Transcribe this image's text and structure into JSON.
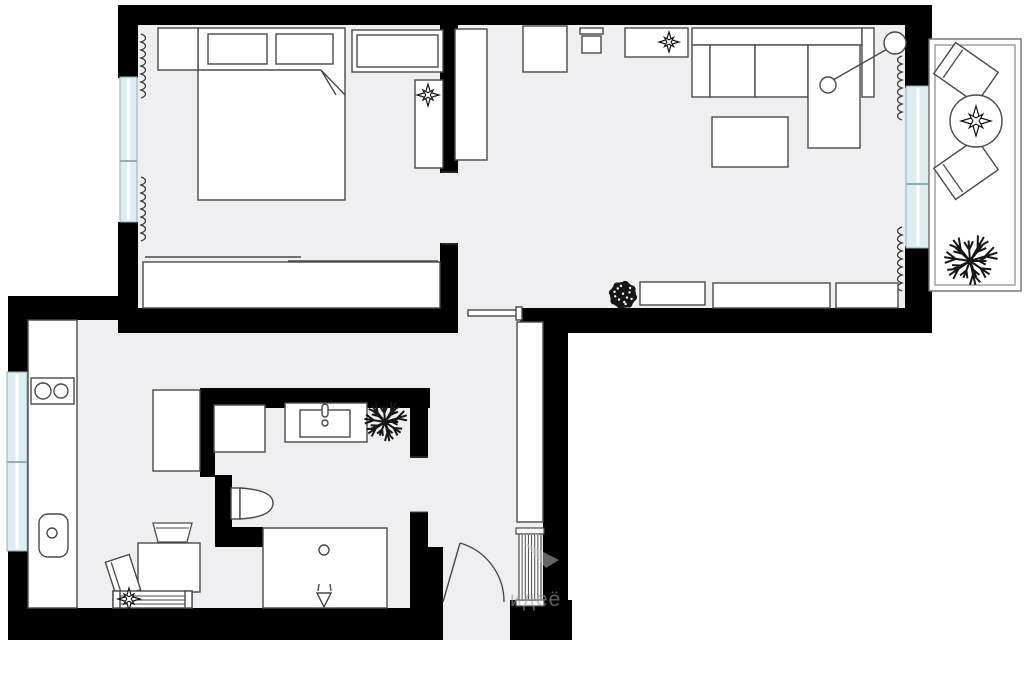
{
  "meta": {
    "description": "apartment floor plan, top-down architectural drawing",
    "canvas_w": 1024,
    "canvas_h": 681
  },
  "palette": {
    "background": "#ffffff",
    "floor": "#efeff1",
    "wall": "#000000",
    "outline": "#4a4a4a",
    "window_fill": "#ddedf1",
    "window_stroke": "#93aeb2",
    "plant_dark": "#161616",
    "balcony_stroke": "#6f6f6f"
  },
  "watermark": {
    "text": "идеё",
    "color": "#9c9c9c",
    "opacity": 0.6
  },
  "floors": [
    {
      "name": "bedroom-floor",
      "x": 130,
      "y": 20,
      "w": 325,
      "h": 295
    },
    {
      "name": "living-room-floor",
      "x": 445,
      "y": 20,
      "w": 470,
      "h": 295
    },
    {
      "name": "kitchen-hall-bathroom-floor",
      "x": 20,
      "y": 305,
      "w": 530,
      "h": 335
    }
  ],
  "walls": [
    {
      "name": "wall-top",
      "x": 118,
      "y": 5,
      "w": 814,
      "h": 20
    },
    {
      "name": "wall-bedroom-left-upper",
      "x": 118,
      "y": 25,
      "w": 20,
      "h": 53
    },
    {
      "name": "wall-bedroom-left-lower",
      "x": 118,
      "y": 222,
      "w": 20,
      "h": 90
    },
    {
      "name": "wall-bedroom-bottom",
      "x": 118,
      "y": 308,
      "w": 340,
      "h": 25
    },
    {
      "name": "wall-divider-upper",
      "x": 440,
      "y": 25,
      "w": 18,
      "h": 148
    },
    {
      "name": "wall-divider-lower",
      "x": 440,
      "y": 243,
      "w": 18,
      "h": 69
    },
    {
      "name": "wall-living-bottom",
      "x": 520,
      "y": 308,
      "w": 412,
      "h": 25
    },
    {
      "name": "wall-living-right-upper",
      "x": 905,
      "y": 25,
      "w": 27,
      "h": 63
    },
    {
      "name": "wall-living-right-lower",
      "x": 905,
      "y": 246,
      "w": 27,
      "h": 87
    },
    {
      "name": "wall-kitchen-top",
      "x": 8,
      "y": 296,
      "w": 114,
      "h": 24
    },
    {
      "name": "wall-kitchen-left-upper",
      "x": 8,
      "y": 310,
      "w": 20,
      "h": 63
    },
    {
      "name": "wall-kitchen-left-lower",
      "x": 8,
      "y": 550,
      "w": 20,
      "h": 90
    },
    {
      "name": "wall-bottom-left",
      "x": 8,
      "y": 608,
      "w": 435,
      "h": 32
    },
    {
      "name": "wall-bottom-right",
      "x": 510,
      "y": 600,
      "w": 62,
      "h": 40
    },
    {
      "name": "wall-hall-right",
      "x": 543,
      "y": 333,
      "w": 25,
      "h": 307
    },
    {
      "name": "wall-bathroom-top",
      "x": 200,
      "y": 388,
      "w": 230,
      "h": 20
    },
    {
      "name": "wall-bathroom-left",
      "x": 200,
      "y": 388,
      "w": 15,
      "h": 89
    },
    {
      "name": "wall-bathroom-left-step",
      "x": 215,
      "y": 475,
      "w": 17,
      "h": 52
    },
    {
      "name": "wall-bathroom-bottom-left",
      "x": 215,
      "y": 527,
      "w": 48,
      "h": 20
    },
    {
      "name": "wall-bathroom-right-upper",
      "x": 410,
      "y": 408,
      "w": 18,
      "h": 50
    },
    {
      "name": "wall-bathroom-right-lower",
      "x": 410,
      "y": 512,
      "w": 18,
      "h": 35
    },
    {
      "name": "wall-entry-left",
      "x": 410,
      "y": 547,
      "w": 33,
      "h": 61
    }
  ],
  "windows": [
    {
      "name": "bedroom-window",
      "x": 120,
      "y": 77,
      "w": 17,
      "h": 145,
      "divider_y": 161
    },
    {
      "name": "kitchen-window",
      "x": 7,
      "y": 372,
      "w": 20,
      "h": 179,
      "divider_y": 462
    },
    {
      "name": "balcony-window",
      "x": 906,
      "y": 86,
      "w": 24,
      "h": 162,
      "divider_y": 184
    }
  ],
  "furniture": [
    {
      "name": "bed",
      "type": "rect",
      "x": 198,
      "y": 28,
      "w": 147,
      "h": 172
    },
    {
      "name": "bed-blanket-line",
      "type": "line",
      "x1": 198,
      "y1": 70,
      "x2": 321,
      "y2": 70
    },
    {
      "name": "bed-blanket-fold",
      "type": "path",
      "d": "M321,70 L345,95 M321,70 L336,95",
      "fill": "none"
    },
    {
      "name": "pillow",
      "type": "rect",
      "x": 208,
      "y": 34,
      "w": 59,
      "h": 30
    },
    {
      "name": "pillow",
      "type": "rect",
      "x": 276,
      "y": 34,
      "w": 57,
      "h": 30
    },
    {
      "name": "nightstand",
      "type": "rect",
      "x": 158,
      "y": 28,
      "w": 40,
      "h": 42
    },
    {
      "name": "dresser",
      "type": "rect",
      "x": 352,
      "y": 30,
      "w": 91,
      "h": 42
    },
    {
      "name": "dresser-inner",
      "type": "rect",
      "x": 357,
      "y": 35,
      "w": 81,
      "h": 32
    },
    {
      "name": "bedroom-shelf",
      "type": "rect",
      "x": 415,
      "y": 80,
      "w": 28,
      "h": 88
    },
    {
      "name": "plant-on-shelf",
      "type": "plant-star",
      "cx": 428,
      "cy": 95,
      "r": 11
    },
    {
      "name": "wardrobe-sliding",
      "type": "rect",
      "x": 143,
      "y": 262,
      "w": 297,
      "h": 46
    },
    {
      "name": "wardrobe-rail",
      "type": "line",
      "x1": 145,
      "y1": 257,
      "x2": 301,
      "y2": 257
    },
    {
      "name": "wardrobe-rail",
      "type": "line",
      "x1": 288,
      "y1": 261,
      "x2": 438,
      "y2": 261
    },
    {
      "name": "curtain",
      "type": "squiggle",
      "x": 141,
      "y1": 34,
      "y2": 96,
      "side": 1
    },
    {
      "name": "curtain",
      "type": "squiggle",
      "x": 141,
      "y1": 177,
      "y2": 241,
      "side": 1
    },
    {
      "name": "doorway-jamb",
      "type": "line",
      "x1": 441,
      "y1": 172,
      "x2": 457,
      "y2": 172,
      "w": 1
    },
    {
      "name": "doorway-jamb",
      "type": "line",
      "x1": 441,
      "y1": 244,
      "x2": 457,
      "y2": 244,
      "w": 1
    },
    {
      "name": "living-wardrobe",
      "type": "rect",
      "x": 455,
      "y": 29,
      "w": 32,
      "h": 131
    },
    {
      "name": "armchair",
      "type": "rect",
      "x": 523,
      "y": 26,
      "w": 44,
      "h": 46
    },
    {
      "name": "desk-chair-back",
      "type": "rect",
      "x": 580,
      "y": 28,
      "w": 23,
      "h": 6
    },
    {
      "name": "desk-chair-seat",
      "type": "rect",
      "x": 582,
      "y": 36,
      "w": 19,
      "h": 17
    },
    {
      "name": "console-table",
      "type": "rect",
      "x": 625,
      "y": 28,
      "w": 63,
      "h": 29
    },
    {
      "name": "plant-on-console",
      "type": "plant-star",
      "cx": 669,
      "cy": 42,
      "r": 10
    },
    {
      "name": "sofa-back",
      "type": "rect",
      "x": 692,
      "y": 28,
      "w": 170,
      "h": 17
    },
    {
      "name": "sofa-armrest",
      "type": "rect",
      "x": 692,
      "y": 45,
      "w": 18,
      "h": 52
    },
    {
      "name": "sofa-seat",
      "type": "rect",
      "x": 710,
      "y": 45,
      "w": 45,
      "h": 52
    },
    {
      "name": "sofa-seat",
      "type": "rect",
      "x": 755,
      "y": 45,
      "w": 53,
      "h": 52
    },
    {
      "name": "sofa-chaise",
      "type": "rect",
      "x": 808,
      "y": 45,
      "w": 52,
      "h": 103
    },
    {
      "name": "sofa-armrest",
      "type": "rect",
      "x": 862,
      "y": 28,
      "w": 12,
      "h": 69
    },
    {
      "name": "floor-lamp-stem",
      "type": "line",
      "x1": 833,
      "y1": 80,
      "x2": 889,
      "y2": 48
    },
    {
      "name": "floor-lamp-base",
      "type": "circle",
      "cx": 828,
      "cy": 85,
      "r": 8
    },
    {
      "name": "floor-lamp-shade",
      "type": "circle",
      "cx": 895,
      "cy": 43,
      "r": 11
    },
    {
      "name": "coffee-table",
      "type": "rect",
      "x": 712,
      "y": 117,
      "w": 76,
      "h": 50
    },
    {
      "name": "curtain",
      "type": "squiggle",
      "x": 902,
      "y1": 56,
      "y2": 114,
      "side": -1
    },
    {
      "name": "curtain",
      "type": "squiggle",
      "x": 902,
      "y1": 227,
      "y2": 289,
      "side": -1
    },
    {
      "name": "plant-floor",
      "type": "plant-bush",
      "cx": 623,
      "cy": 295,
      "r": 13
    },
    {
      "name": "sideboard",
      "type": "rect",
      "x": 640,
      "y": 282,
      "w": 65,
      "h": 23
    },
    {
      "name": "sideboard",
      "type": "rect",
      "x": 713,
      "y": 283,
      "w": 117,
      "h": 25
    },
    {
      "name": "sideboard",
      "type": "rect",
      "x": 836,
      "y": 283,
      "w": 62,
      "h": 25
    },
    {
      "name": "pocket-door",
      "type": "rect",
      "x": 468,
      "y": 310,
      "w": 50,
      "h": 6
    },
    {
      "name": "pocket-door-cap",
      "type": "rect",
      "x": 516,
      "y": 307,
      "w": 6,
      "h": 13
    },
    {
      "name": "hall-closet",
      "type": "rect",
      "x": 517,
      "y": 322,
      "w": 26,
      "h": 200
    },
    {
      "name": "radiator",
      "type": "radiator",
      "x": 516,
      "y": 528,
      "w": 28,
      "h": 78
    },
    {
      "name": "entry-door-leaf",
      "type": "line",
      "x1": 443,
      "y1": 602,
      "x2": 460,
      "y2": 543
    },
    {
      "name": "entry-door-swing",
      "type": "path",
      "d": "M460,543 A61,61 0 0 1 504,602",
      "fill": "none"
    },
    {
      "name": "washing-machine",
      "type": "rect",
      "x": 214,
      "y": 405,
      "w": 51,
      "h": 47
    },
    {
      "name": "vanity",
      "type": "rect",
      "x": 285,
      "y": 403,
      "w": 82,
      "h": 39
    },
    {
      "name": "vanity-sink",
      "type": "rect",
      "x": 300,
      "y": 410,
      "w": 50,
      "h": 27
    },
    {
      "name": "faucet",
      "type": "rect",
      "x": 322,
      "y": 404,
      "w": 6,
      "h": 13,
      "rx": 3
    },
    {
      "name": "faucet-dot",
      "type": "circle",
      "cx": 325,
      "cy": 423,
      "r": 3
    },
    {
      "name": "plant-bathroom",
      "type": "plant-spiky",
      "cx": 385,
      "cy": 422,
      "r": 24
    },
    {
      "name": "toilet-tank",
      "type": "rect",
      "x": 231,
      "y": 488,
      "w": 9,
      "h": 31
    },
    {
      "name": "toilet-bowl",
      "type": "path",
      "d": "M240,488 Q273,490 273,503 Q273,517 240,519 Z"
    },
    {
      "name": "bathroom-door-jamb",
      "type": "line",
      "x1": 410,
      "y1": 457,
      "x2": 428,
      "y2": 457,
      "w": 1
    },
    {
      "name": "bathroom-door-jamb",
      "type": "line",
      "x1": 410,
      "y1": 512,
      "x2": 428,
      "y2": 512,
      "w": 1
    },
    {
      "name": "shower",
      "type": "rect",
      "x": 263,
      "y": 528,
      "w": 124,
      "h": 80
    },
    {
      "name": "shower-drain",
      "type": "circle",
      "cx": 324,
      "cy": 550,
      "r": 5
    },
    {
      "name": "shower-slope-arrow",
      "type": "path",
      "d": "M317,593 L331,593 L324,607 Z M319,584 L318,591 M330,584 L331,591",
      "fill": "none"
    },
    {
      "name": "kitchen-counter",
      "type": "rect",
      "x": 28,
      "y": 320,
      "w": 49,
      "h": 288
    },
    {
      "name": "hob",
      "type": "rect",
      "x": 31,
      "y": 378,
      "w": 43,
      "h": 26
    },
    {
      "name": "hob-burner",
      "type": "circle",
      "cx": 43,
      "cy": 391,
      "r": 8
    },
    {
      "name": "hob-burner",
      "type": "circle",
      "cx": 61,
      "cy": 391,
      "r": 7
    },
    {
      "name": "kitchen-sink",
      "type": "rect",
      "x": 39,
      "y": 514,
      "w": 29,
      "h": 43,
      "rx": 9
    },
    {
      "name": "sink-drain",
      "type": "circle",
      "cx": 52,
      "cy": 533,
      "r": 5
    },
    {
      "name": "fridge",
      "type": "rect",
      "x": 153,
      "y": 390,
      "w": 47,
      "h": 81
    },
    {
      "name": "dining-table",
      "type": "rect",
      "x": 138,
      "y": 543,
      "w": 62,
      "h": 49
    },
    {
      "name": "dining-chair",
      "type": "polygon",
      "points": "153,523 192,523 187,542 158,542"
    },
    {
      "name": "dining-chair-back",
      "type": "line",
      "x1": 156,
      "y1": 528,
      "x2": 189,
      "y2": 528,
      "w": 1
    },
    {
      "name": "dining-chair",
      "type": "chair-rot",
      "cx": 123,
      "cy": 576,
      "w": 25,
      "h": 37,
      "angle": -18,
      "back": -7
    },
    {
      "name": "bench",
      "type": "rect",
      "x": 113,
      "y": 591,
      "w": 79,
      "h": 17
    },
    {
      "name": "bench-cap",
      "type": "rect",
      "x": 113,
      "y": 591,
      "w": 7,
      "h": 17
    },
    {
      "name": "bench-cap",
      "type": "rect",
      "x": 185,
      "y": 591,
      "w": 7,
      "h": 17
    },
    {
      "name": "bench-slat",
      "type": "line",
      "x1": 120,
      "y1": 596,
      "x2": 185,
      "y2": 596,
      "w": 1
    },
    {
      "name": "bench-slat",
      "type": "line",
      "x1": 120,
      "y1": 600,
      "x2": 185,
      "y2": 600,
      "w": 1
    },
    {
      "name": "bench-slat",
      "type": "line",
      "x1": 120,
      "y1": 604,
      "x2": 185,
      "y2": 604,
      "w": 1
    },
    {
      "name": "plant-on-bench",
      "type": "plant-star",
      "cx": 129,
      "cy": 599,
      "r": 11
    },
    {
      "name": "balcony-rail",
      "type": "rect",
      "x": 929,
      "y": 39,
      "w": 92,
      "h": 252,
      "stroke": "#6f6f6f"
    },
    {
      "name": "balcony-rail-inner",
      "type": "rect",
      "x": 935,
      "y": 45,
      "w": 80,
      "h": 240,
      "fill": "none",
      "stroke": "#9a9a9a"
    },
    {
      "name": "balcony-chair",
      "type": "chair-rot",
      "cx": 966,
      "cy": 73,
      "w": 52,
      "h": 38,
      "angle": 35,
      "back": -16
    },
    {
      "name": "balcony-chair",
      "type": "chair-rot",
      "cx": 966,
      "cy": 169,
      "w": 52,
      "h": 38,
      "angle": -35,
      "back": -16
    },
    {
      "name": "balcony-table",
      "type": "circle",
      "cx": 976,
      "cy": 121,
      "r": 26
    },
    {
      "name": "plant-on-table",
      "type": "plant-star",
      "cx": 976,
      "cy": 121,
      "r": 15
    },
    {
      "name": "plant-balcony",
      "type": "plant-spiky",
      "cx": 970,
      "cy": 261,
      "r": 30
    },
    {
      "name": "watermark-swoosh",
      "type": "polygon",
      "points": "522,541 559,560 546,568",
      "fill": "#c9c9c9",
      "stroke": "none",
      "opacity": 0.5
    }
  ]
}
